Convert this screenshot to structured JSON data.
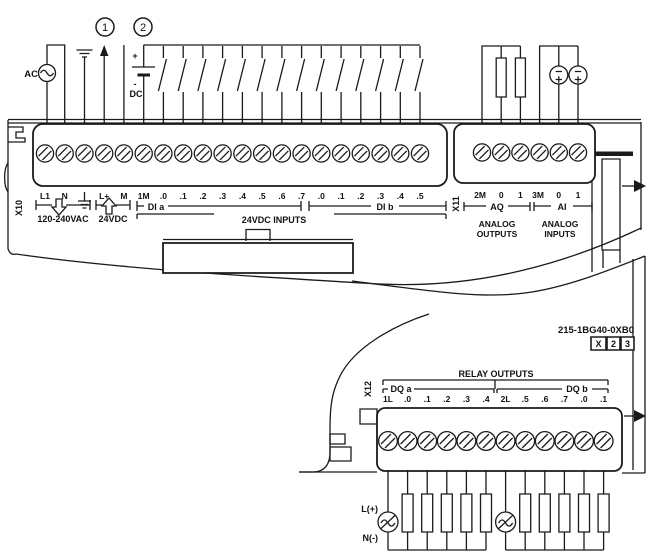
{
  "part_number": "215-1BG40-0XB0",
  "version_boxes": [
    "X",
    "2",
    "3"
  ],
  "callouts": {
    "one": "1",
    "two": "2"
  },
  "power": {
    "ac_label": "AC",
    "dc_label": "DC",
    "plus": "+",
    "minus": "-"
  },
  "x10": {
    "connector": "X10",
    "terminals": [
      "L1",
      "N",
      "",
      "L+",
      "M",
      "1M",
      ".0",
      ".1",
      ".2",
      ".3",
      ".4",
      ".5",
      ".6",
      ".7",
      ".0",
      ".1",
      ".2",
      ".3",
      ".4",
      ".5"
    ],
    "group_line_voltage": "120-240VAC",
    "group_24vdc": "24VDC",
    "group_di_a": "DI a",
    "group_di_b": "DI b",
    "group_inputs": "24VDC INPUTS"
  },
  "x11": {
    "connector": "X11",
    "terminals": [
      "2M",
      "0",
      "1",
      "3M",
      "0",
      "1"
    ],
    "group_aq": "AQ",
    "group_ai": "AI",
    "analog_outputs_1": "ANALOG",
    "analog_outputs_2": "OUTPUTS",
    "analog_inputs_1": "ANALOG",
    "analog_inputs_2": "INPUTS"
  },
  "x12": {
    "connector": "X12",
    "header": "RELAY OUTPUTS",
    "group_dq_a": "DQ a",
    "group_dq_b": "DQ b",
    "terminals": [
      "1L",
      ".0",
      ".1",
      ".2",
      ".3",
      ".4",
      "2L",
      ".5",
      ".6",
      ".7",
      ".0",
      ".1"
    ],
    "supply_plus": "L(+)",
    "supply_minus": "N(-)"
  },
  "colors": {
    "line": "#1a1a1a",
    "background": "#ffffff"
  }
}
